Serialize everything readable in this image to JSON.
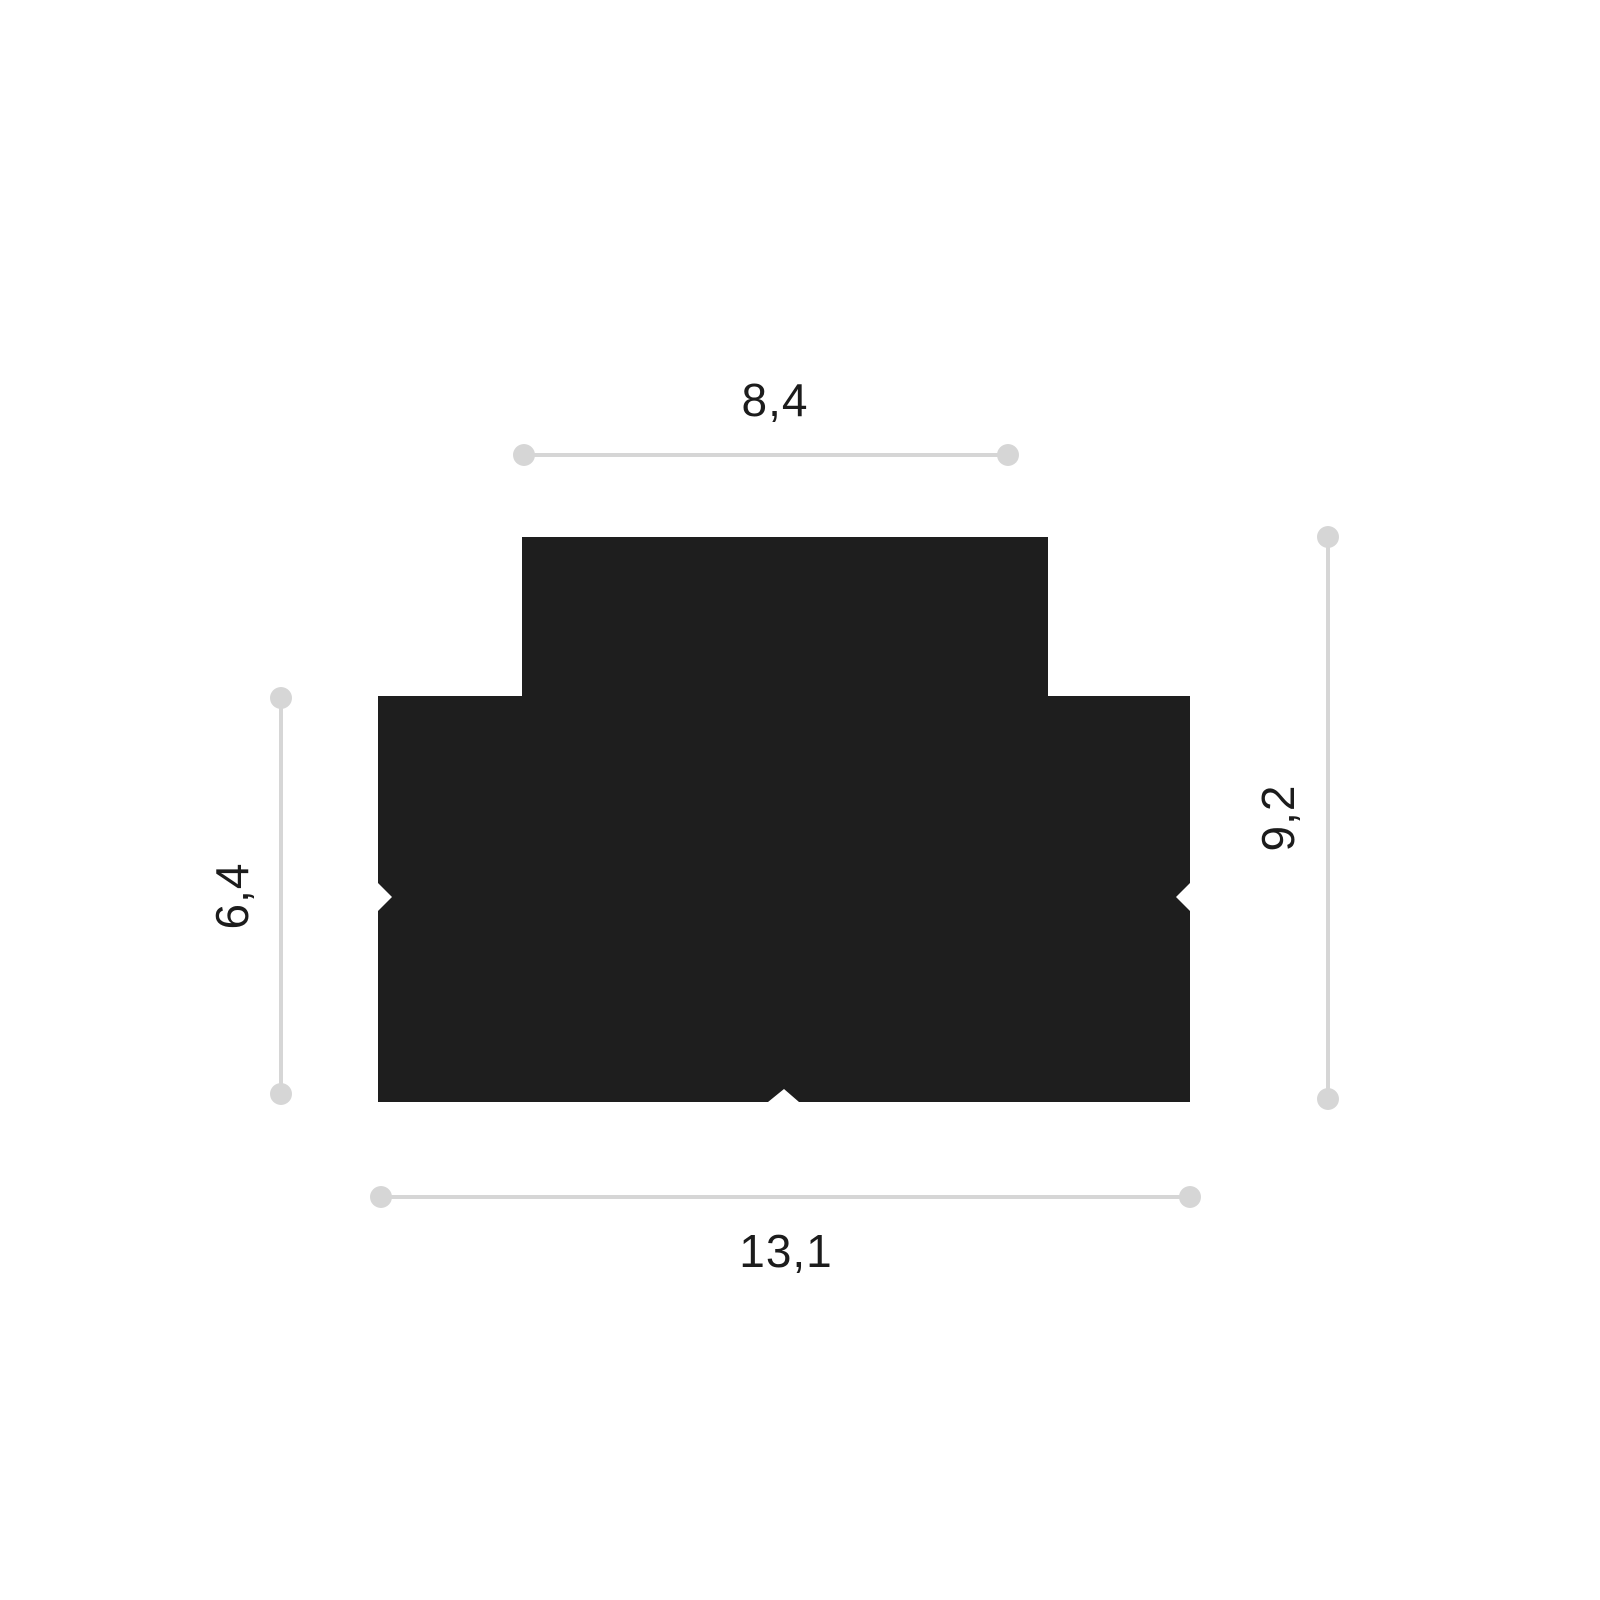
{
  "diagram": {
    "title": "profile-cross-section-dimension-drawing",
    "colors": {
      "background": "#ffffff",
      "shape": "#1e1e1e",
      "dimension_line": "#d6d6d6",
      "text": "#1c1c1c"
    },
    "dimensions": {
      "top": "8,4",
      "left": "6,4",
      "right": "9,2",
      "bottom": "13,1"
    },
    "profile_points": "522,537 1048,537 1048,696 1190,696 1190,883 1176,897 1190,911 1190,1102 799,1102 784,1089 768,1102 378,1102 378,911 392,897 378,883 378,696 522,696",
    "dimension_lines": {
      "top": {
        "x1": 524,
        "y1": 455,
        "x2": 1008,
        "y2": 455
      },
      "bottom": {
        "x1": 381,
        "y1": 1197,
        "x2": 1190,
        "y2": 1197
      },
      "left": {
        "x1": 281,
        "y1": 698,
        "x2": 281,
        "y2": 1094
      },
      "right": {
        "x1": 1328,
        "y1": 537,
        "x2": 1328,
        "y2": 1099
      }
    },
    "line_width": 4,
    "dot_radius": 11
  }
}
